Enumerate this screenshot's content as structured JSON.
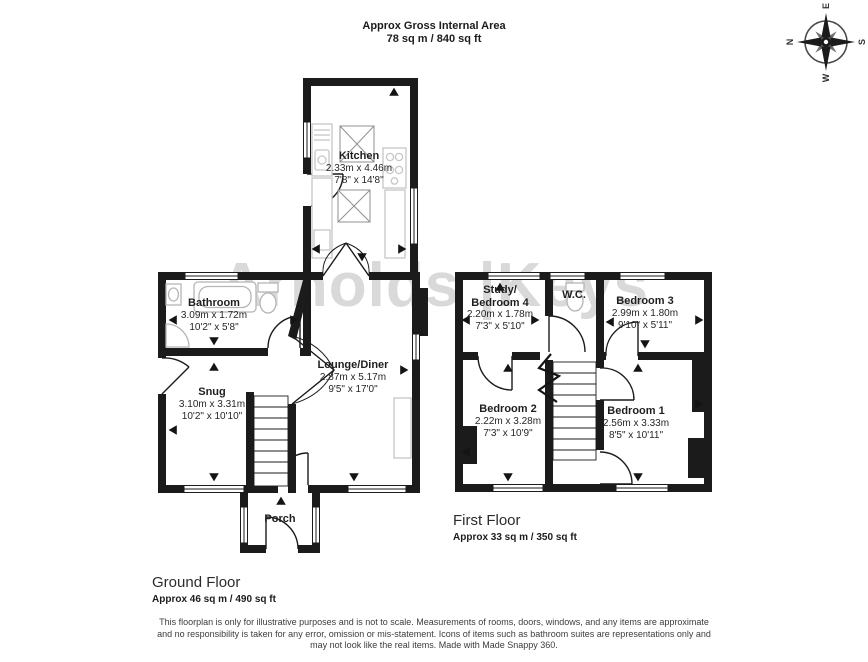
{
  "header": {
    "title": "Approx Gross Internal Area",
    "subtitle": "78 sq m / 840 sq ft"
  },
  "watermark": "Arnolds |Keys",
  "compass": {
    "north": "N",
    "east": "E",
    "south": "S",
    "west": "W"
  },
  "ground_floor": {
    "label": "Ground Floor",
    "area": "Approx 46 sq m / 490 sq ft",
    "rooms": {
      "kitchen": {
        "name": "Kitchen",
        "metric": "2.33m x 4.46m",
        "imperial": "7'8\" x 14'8\""
      },
      "bathroom": {
        "name": "Bathroom",
        "metric": "3.09m x 1.72m",
        "imperial": "10'2\" x 5'8\""
      },
      "snug": {
        "name": "Snug",
        "metric": "3.10m x 3.31m",
        "imperial": "10'2\" x 10'10\""
      },
      "lounge_diner": {
        "name": "Lounge/Diner",
        "metric": "2.87m x 5.17m",
        "imperial": "9'5\" x 17'0\""
      },
      "porch": {
        "name": "Porch"
      }
    }
  },
  "first_floor": {
    "label": "First Floor",
    "area": "Approx 33 sq m / 350 sq ft",
    "rooms": {
      "study_bedroom4": {
        "name": "Study/\nBedroom 4",
        "metric": "2.20m x 1.78m",
        "imperial": "7'3\" x 5'10\""
      },
      "wc": {
        "name": "W.C."
      },
      "bedroom3": {
        "name": "Bedroom 3",
        "metric": "2.99m x 1.80m",
        "imperial": "9'10\" x 5'11\""
      },
      "bedroom2": {
        "name": "Bedroom 2",
        "metric": "2.22m x 3.28m",
        "imperial": "7'3\" x 10'9\""
      },
      "bedroom1": {
        "name": "Bedroom 1",
        "metric": "2.56m x 3.33m",
        "imperial": "8'5\" x 10'11\""
      }
    }
  },
  "disclaimer": "This floorplan is only for illustrative purposes and is not to scale. Measurements of rooms, doors, windows, and any items are approximate\nand no responsibility is taken for any error, omission or mis-statement. Icons of items such as bathroom suites are representations only and\nmay not look like the real items. Made with Made Snappy 360.",
  "colors": {
    "wall": "#1b1b1b",
    "fixture": "#c7c7c7",
    "watermark": "#d9d9d9"
  }
}
